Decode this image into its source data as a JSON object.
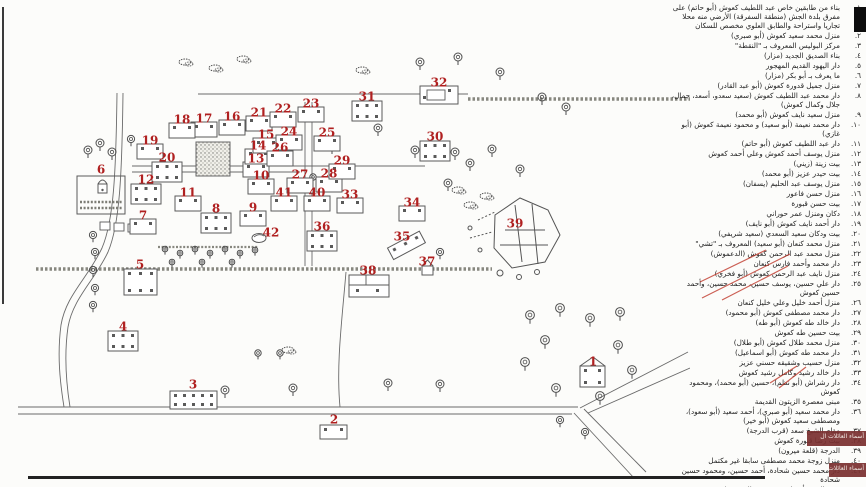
{
  "colors": {
    "marker_red": "#b02020",
    "ink": "#5a5a5a",
    "wall": "#87877f",
    "scribble_red": "#c0392b",
    "watermark_bg": "#7a3030"
  },
  "map": {
    "markers": [
      {
        "n": "1",
        "x": 593,
        "y": 362,
        "type": "iso"
      },
      {
        "n": "2",
        "x": 334,
        "y": 420,
        "type": "small"
      },
      {
        "n": "3",
        "x": 193,
        "y": 385,
        "type": "long"
      },
      {
        "n": "4",
        "x": 123,
        "y": 327,
        "type": "two"
      },
      {
        "n": "5",
        "x": 140,
        "y": 265,
        "type": "large"
      },
      {
        "n": "6",
        "x": 101,
        "y": 170,
        "type": "yard"
      },
      {
        "n": "7",
        "x": 143,
        "y": 216,
        "type": "house"
      },
      {
        "n": "8",
        "x": 216,
        "y": 209,
        "type": "two"
      },
      {
        "n": "9",
        "x": 253,
        "y": 208,
        "type": "house"
      },
      {
        "n": "10",
        "x": 261,
        "y": 176,
        "type": "house"
      },
      {
        "n": "11",
        "x": 188,
        "y": 193,
        "type": "house"
      },
      {
        "n": "12",
        "x": 146,
        "y": 180,
        "type": "two"
      },
      {
        "n": "13",
        "x": 256,
        "y": 159,
        "type": "house"
      },
      {
        "n": "14",
        "x": 258,
        "y": 146,
        "type": "house"
      },
      {
        "n": "15",
        "x": 266,
        "y": 135,
        "type": "house"
      },
      {
        "n": "16",
        "x": 232,
        "y": 117,
        "type": "house"
      },
      {
        "n": "17",
        "x": 204,
        "y": 119,
        "type": "house"
      },
      {
        "n": "18",
        "x": 182,
        "y": 120,
        "type": "house"
      },
      {
        "n": "19",
        "x": 150,
        "y": 141,
        "type": "house"
      },
      {
        "n": "20",
        "x": 167,
        "y": 158,
        "type": "two"
      },
      {
        "n": "21",
        "x": 259,
        "y": 113,
        "type": "house"
      },
      {
        "n": "22",
        "x": 283,
        "y": 109,
        "type": "house"
      },
      {
        "n": "23",
        "x": 311,
        "y": 104,
        "type": "house"
      },
      {
        "n": "24",
        "x": 289,
        "y": 132,
        "type": "house"
      },
      {
        "n": "25",
        "x": 327,
        "y": 133,
        "type": "house"
      },
      {
        "n": "26",
        "x": 280,
        "y": 148,
        "type": "house"
      },
      {
        "n": "27",
        "x": 300,
        "y": 175,
        "type": "house"
      },
      {
        "n": "28",
        "x": 329,
        "y": 174,
        "type": "house"
      },
      {
        "n": "29",
        "x": 342,
        "y": 161,
        "type": "house"
      },
      {
        "n": "30",
        "x": 435,
        "y": 137,
        "type": "two"
      },
      {
        "n": "31",
        "x": 367,
        "y": 97,
        "type": "two"
      },
      {
        "n": "32",
        "x": 439,
        "y": 83,
        "type": "court"
      },
      {
        "n": "33",
        "x": 350,
        "y": 195,
        "type": "house"
      },
      {
        "n": "34",
        "x": 412,
        "y": 203,
        "type": "house"
      },
      {
        "n": "35",
        "x": 402,
        "y": 237,
        "type": "press"
      },
      {
        "n": "36",
        "x": 322,
        "y": 227,
        "type": "two"
      },
      {
        "n": "37",
        "x": 427,
        "y": 262,
        "type": "shrine"
      },
      {
        "n": "38",
        "x": 368,
        "y": 271,
        "type": "compound"
      },
      {
        "n": "39",
        "x": 515,
        "y": 224,
        "type": "none"
      },
      {
        "n": "40",
        "x": 317,
        "y": 193,
        "type": "house"
      },
      {
        "n": "41",
        "x": 284,
        "y": 193,
        "type": "house"
      },
      {
        "n": "42",
        "x": 271,
        "y": 233,
        "type": "stone"
      }
    ]
  },
  "legend": {
    "items": [
      {
        "num": "١.",
        "text": "بناء من طابقين خاص عبد اللطيف كعوش (أبو حاتم) على مفرق بلدة الجش (منطقة السفرقة) الأرضي منه محلا تجاريا واستراحة والطابق العلوي مخصص للسكان"
      },
      {
        "num": "٢.",
        "text": "منزل محمد سعيد كعوش (أبو صبري)"
      },
      {
        "num": "٣.",
        "text": "مركز البوليس المعروف بـ \"النقطة\""
      },
      {
        "num": "٤.",
        "text": "بناء الصديق الجديد (مزار)"
      },
      {
        "num": "٥.",
        "text": "دار اليهود القديم المهجور"
      },
      {
        "num": "٦.",
        "text": "ما يعرف بـ أبو بكر (مزار)"
      },
      {
        "num": "٧.",
        "text": "منزل جميل قدورة كعوش (أبو عبد القادر)"
      },
      {
        "num": "٨.",
        "text": "دار محمد عبد اللطيف كعوش (سعيد سعدو، أسعد، جمال، جلال وكمال كعوش)"
      },
      {
        "num": "٩.",
        "text": "منزل سعيد نايف كعوش (أبو محمد)"
      },
      {
        "num": "١٠.",
        "text": "دار محمد نعيمة (أبو سعيد) و محمود نعيمة كعوش (أبو غازي)"
      },
      {
        "num": "١١.",
        "text": "دار عبد اللطيف كعوش (أبو حاتم)"
      },
      {
        "num": "١٢.",
        "text": "منزل يوسف أحمد كعوش وعلي أحمد كعوش"
      },
      {
        "num": "١٣.",
        "text": "بيت زينة (زيني)"
      },
      {
        "num": "١٤.",
        "text": "بيت حيدر عزيز (أبو محمد)"
      },
      {
        "num": "١٥.",
        "text": "منزل يوسف عبد الحليم (يسفان)"
      },
      {
        "num": "١٦.",
        "text": "منزل حسن فاعور"
      },
      {
        "num": "١٧.",
        "text": "بيت حسن قبورة"
      },
      {
        "num": "١٨.",
        "text": "دكان ومنزل عمر حوراني"
      },
      {
        "num": "١٩.",
        "text": "دار أحمد نايف كعوش (أبو نايف)"
      },
      {
        "num": "٢٠.",
        "text": "بيت ودكان سعيد السعدي (سعيد شريفي)"
      },
      {
        "num": "٢١.",
        "text": "منزل محمد كنعان (أبو سعيد) المعروف بـ \"تشي\""
      },
      {
        "num": "٢٢.",
        "text": "منزل محمد عبد الرحمن كعوش (الدعموش)"
      },
      {
        "num": "٢٣.",
        "text": "دار محمد وأحمد فارس كنعان"
      },
      {
        "num": "٢٤.",
        "text": "منزل نايف عبد الرحمن كعوش (أبو فخري)"
      },
      {
        "num": "٢٥.",
        "text": "دار علي حسين، يوسف حسين، محمد حسين، وأحمد حسين كعوش"
      },
      {
        "num": "٢٦.",
        "text": "منزل أحمد خليل وعلي خليل كنعان"
      },
      {
        "num": "٢٧.",
        "text": "دار محمد مصطفى كعوش (أبو محمود)"
      },
      {
        "num": "٢٨.",
        "text": "دار خالد طه كعوش (أبو طه)"
      },
      {
        "num": "٢٩.",
        "text": "بيت حسين طه كعوش"
      },
      {
        "num": "٣٠.",
        "text": "منزل محمد طلال كعوش (أبو طلال)"
      },
      {
        "num": "٣١.",
        "text": "دار محمد طه كعوش (أبو اسماعيل)"
      },
      {
        "num": "٣٢.",
        "text": "منزل حسيب وشقيقه حسني عزيز"
      },
      {
        "num": "٣٣.",
        "text": "دار خالد رشيد وكامل رشيد كعوش"
      },
      {
        "num": "٣٤.",
        "text": "دار رشراش (أبو نظم)، حسين (أبو محمد)، ومحمود كعوش"
      },
      {
        "num": "٣٥.",
        "text": "مبنى معصرة الزيتون القديمة"
      },
      {
        "num": "٣٦.",
        "text": "دار محمد سعيد (أبو صبري)، أحمد سعيد (أبو سعود)، ومصطفى سعيد كعوش (أبو خير)"
      },
      {
        "num": "٣٧.",
        "text": "مقام الشيخ سعد (قرب الدرجة)"
      },
      {
        "num": "٣٨.",
        "text": "بيت رضا قبورة كعوش"
      },
      {
        "num": "٣٩.",
        "text": "الدرجة (قلعة ميرون)"
      },
      {
        "num": "٤٠.",
        "text": "منزل زوجة محمد مصطفى سابقا غير مكتمل"
      },
      {
        "num": "٤١.",
        "text": "دار محمد حسين شحادة، أحمد حسين، ومحمود حسين شحادة"
      },
      {
        "num": "٤٢.",
        "text": "حجر الصفه أو ما يعرف بحجر المصفه (قرب"
      }
    ]
  },
  "overlays": {
    "watermark_text": "أسماء العائلات ال"
  }
}
